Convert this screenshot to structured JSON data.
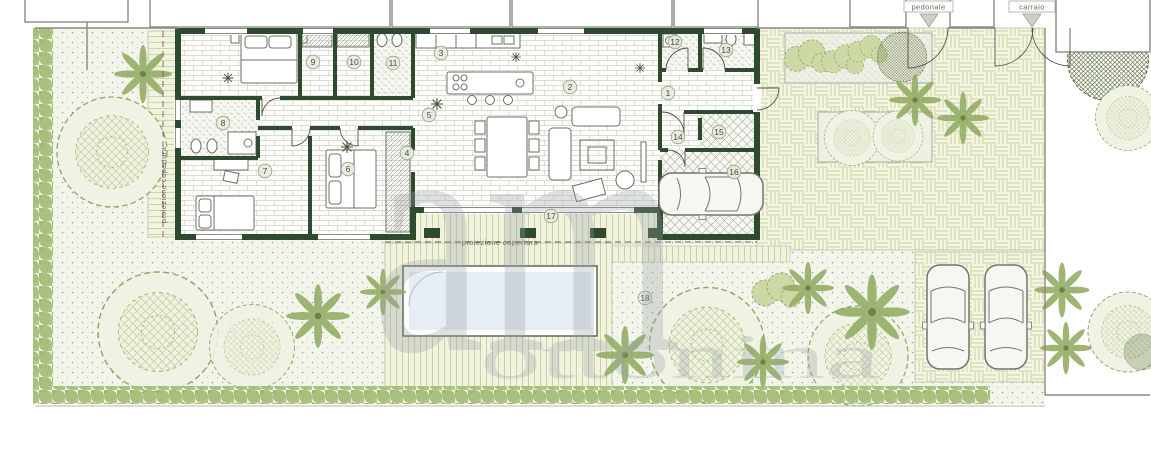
{
  "labels": {
    "gate_pedestrian": "pedonale",
    "gate_driveway": "carraio",
    "roof_projection": "proiezione copertura"
  },
  "watermark": {
    "monogram": "am",
    "name": "ottonina"
  },
  "rooms": [
    {
      "number": "1",
      "x": 668,
      "y": 93
    },
    {
      "number": "2",
      "x": 570,
      "y": 87
    },
    {
      "number": "3",
      "x": 441,
      "y": 53
    },
    {
      "number": "4",
      "x": 407,
      "y": 153
    },
    {
      "number": "5",
      "x": 429,
      "y": 115
    },
    {
      "number": "6",
      "x": 348,
      "y": 169
    },
    {
      "number": "7",
      "x": 265,
      "y": 171
    },
    {
      "number": "8",
      "x": 223,
      "y": 123
    },
    {
      "number": "9",
      "x": 313,
      "y": 62
    },
    {
      "number": "10",
      "x": 354,
      "y": 62
    },
    {
      "number": "11",
      "x": 393,
      "y": 63
    },
    {
      "number": "12",
      "x": 675,
      "y": 42
    },
    {
      "number": "13",
      "x": 726,
      "y": 50
    },
    {
      "number": "14",
      "x": 678,
      "y": 137
    },
    {
      "number": "15",
      "x": 719,
      "y": 132
    },
    {
      "number": "16",
      "x": 734,
      "y": 172
    },
    {
      "number": "17",
      "x": 551,
      "y": 216
    },
    {
      "number": "18",
      "x": 645,
      "y": 298
    }
  ],
  "colors": {
    "wall": "#2e4a2f",
    "pool_water": "#e6edf4",
    "hedge": "#a9bf7d",
    "lawn": "#f3f5ea",
    "paving": "#f4f5e2",
    "tree_stroke": "#8fa763",
    "watermark": "#99a0a7"
  }
}
